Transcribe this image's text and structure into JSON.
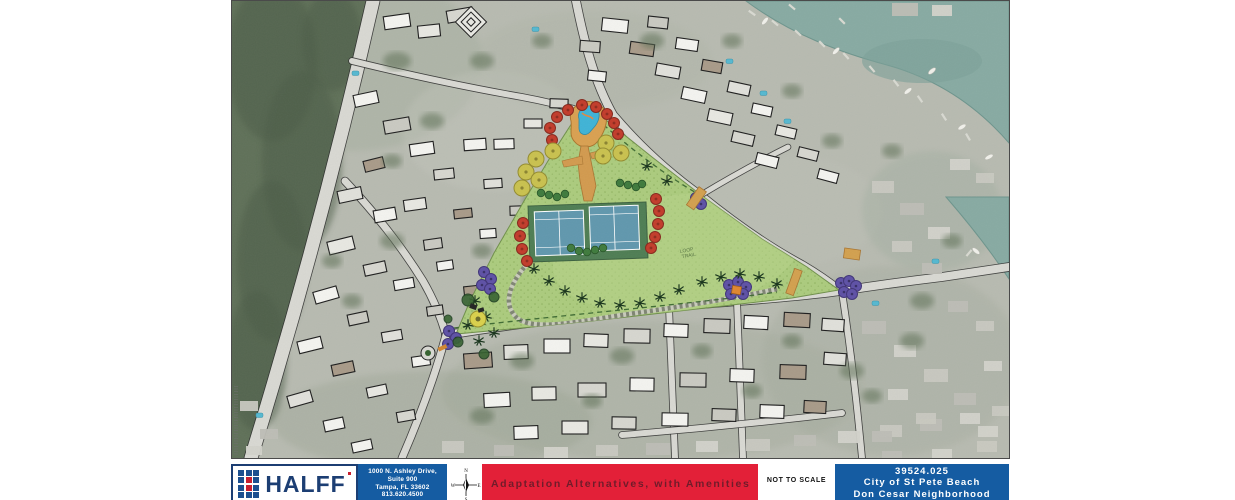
{
  "map": {
    "annotations": {
      "loop_trail_line1": "LOOP",
      "loop_trail_line2": "TRAIL"
    }
  },
  "title_block": {
    "logo_text": "HALFF",
    "address_lines": [
      "1000 N. Ashley Drive,",
      "Suite 900",
      "Tampa, FL 33602",
      "813.620.4500"
    ],
    "compass": {
      "n": "N",
      "s": "S",
      "e": "E",
      "w": "W"
    },
    "title": "Adaptation Alternatives, with Amenities",
    "scale_note": "NOT TO SCALE",
    "project_number": "39524.025",
    "client": "City of St Pete Beach",
    "neighborhood": "Don Cesar Neighborhood",
    "colors": {
      "halff_navy": "#1c3e73",
      "halff_red": "#c8202f",
      "panel_blue": "#155ca2",
      "band_red": "#e32038",
      "band_text": "#701c2a",
      "water_teal": "#87aaa2",
      "park_green": "#abcb7d"
    }
  }
}
